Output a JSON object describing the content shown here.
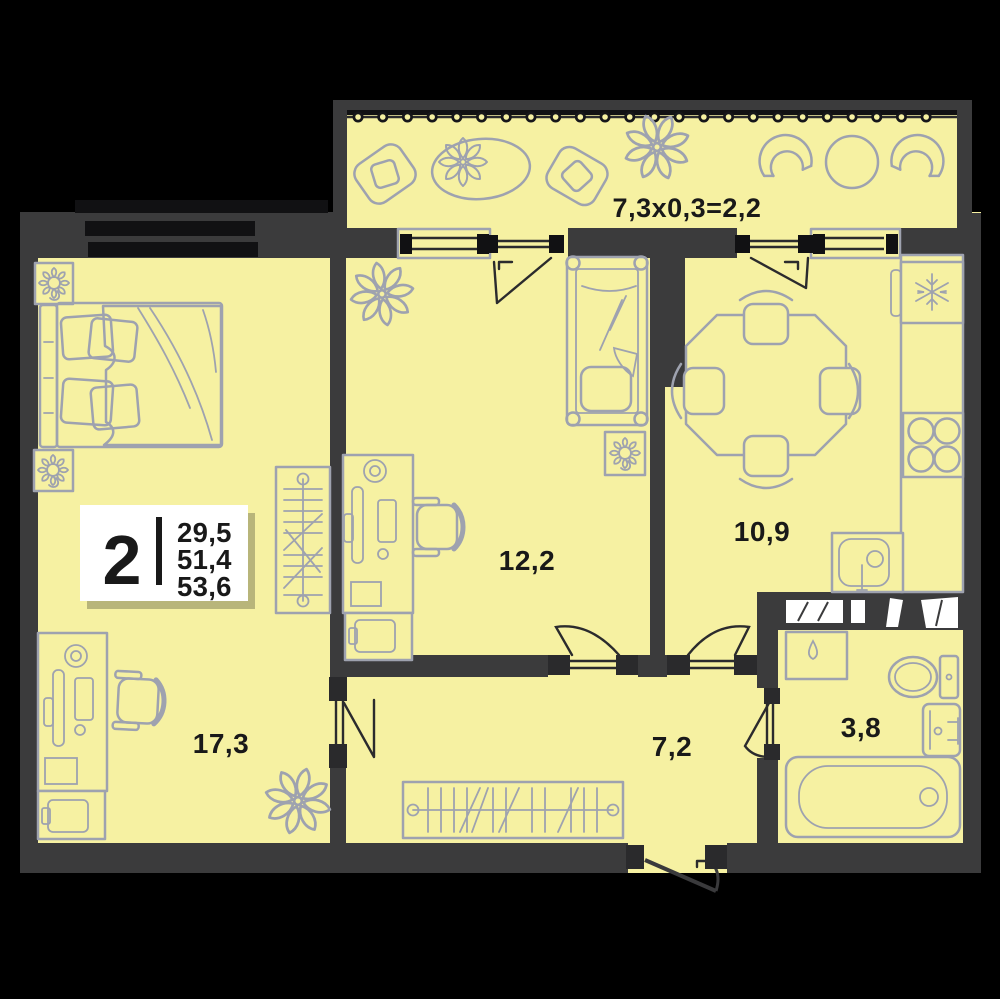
{
  "plan": {
    "type": "apartment-floor-plan",
    "badge": {
      "rooms_count": "2",
      "area_living": "29,5",
      "area_apartment": "51,4",
      "area_total": "53,6"
    },
    "labels": {
      "bedroom": "17,3",
      "room2": "12,2",
      "kitchen": "10,9",
      "hallway": "7,2",
      "bathroom": "3,8",
      "balcony_formula": "7,3x0,3=2,2"
    },
    "colors": {
      "background": "#000000",
      "floor": "#F6F1A2",
      "wall": "#3B3B3C",
      "furniture_line": "#9EA2AF",
      "label_text": "#191919",
      "badge_background": "#FFFFFF"
    }
  }
}
